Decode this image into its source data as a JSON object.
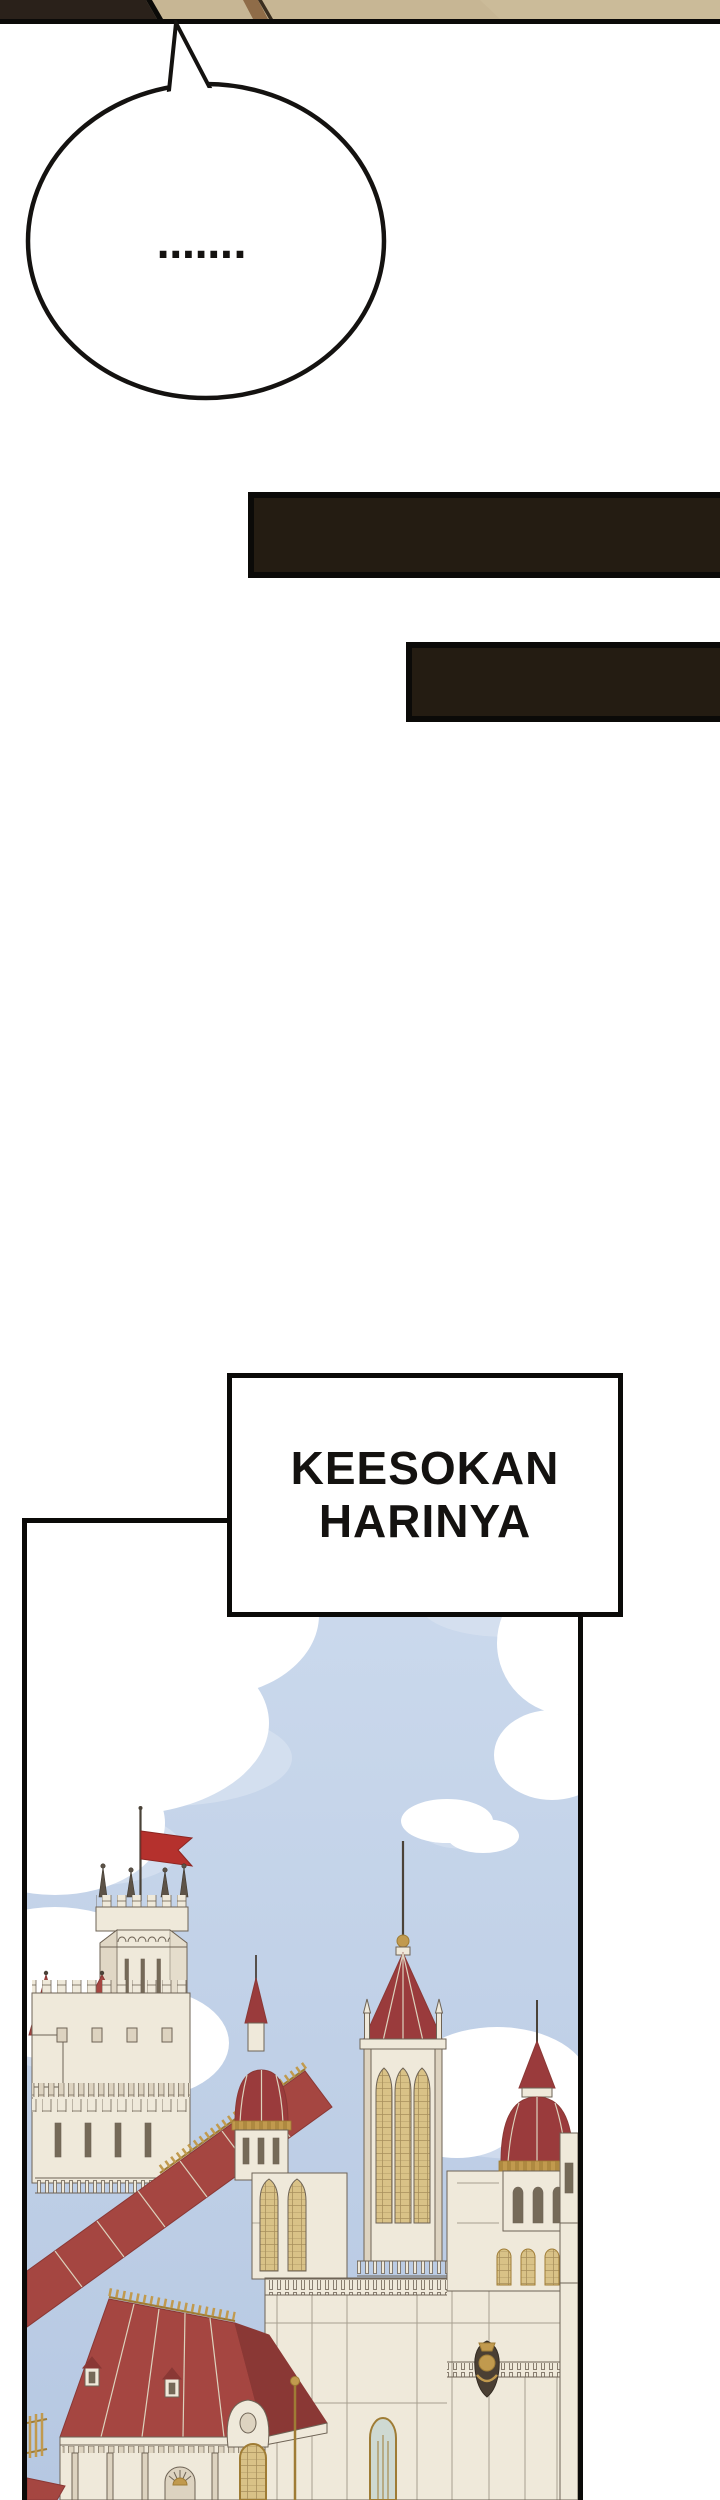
{
  "comic": {
    "speech_bubble": {
      "text": "……."
    },
    "caption": {
      "line1": "KEESOKAN",
      "line2": "HARINYA"
    }
  },
  "colors": {
    "ink": "#0b0a08",
    "bar": "#241c12",
    "tan": "#c7b694",
    "tan2": "#cdbd9b",
    "tandark": "#2a211a",
    "stripe": "#8f6c48",
    "sky1": "#ccdaed",
    "sky2": "#b6c8e2",
    "cloud": "#ffffff",
    "cloudsh": "#d9e3f1",
    "wall": "#efe9da",
    "wallsh": "#ddd3c0",
    "line": "#6e6355",
    "roof": "#a54641",
    "roofdark": "#8a3835",
    "roofdeep": "#9a3b3c",
    "flag": "#b5312d",
    "gold": "#c19a4e",
    "golddark": "#9f7c35",
    "glass": "#ced9d2",
    "lattice": "#d9c287",
    "win": "#756a58",
    "metal": "#4a4238"
  }
}
